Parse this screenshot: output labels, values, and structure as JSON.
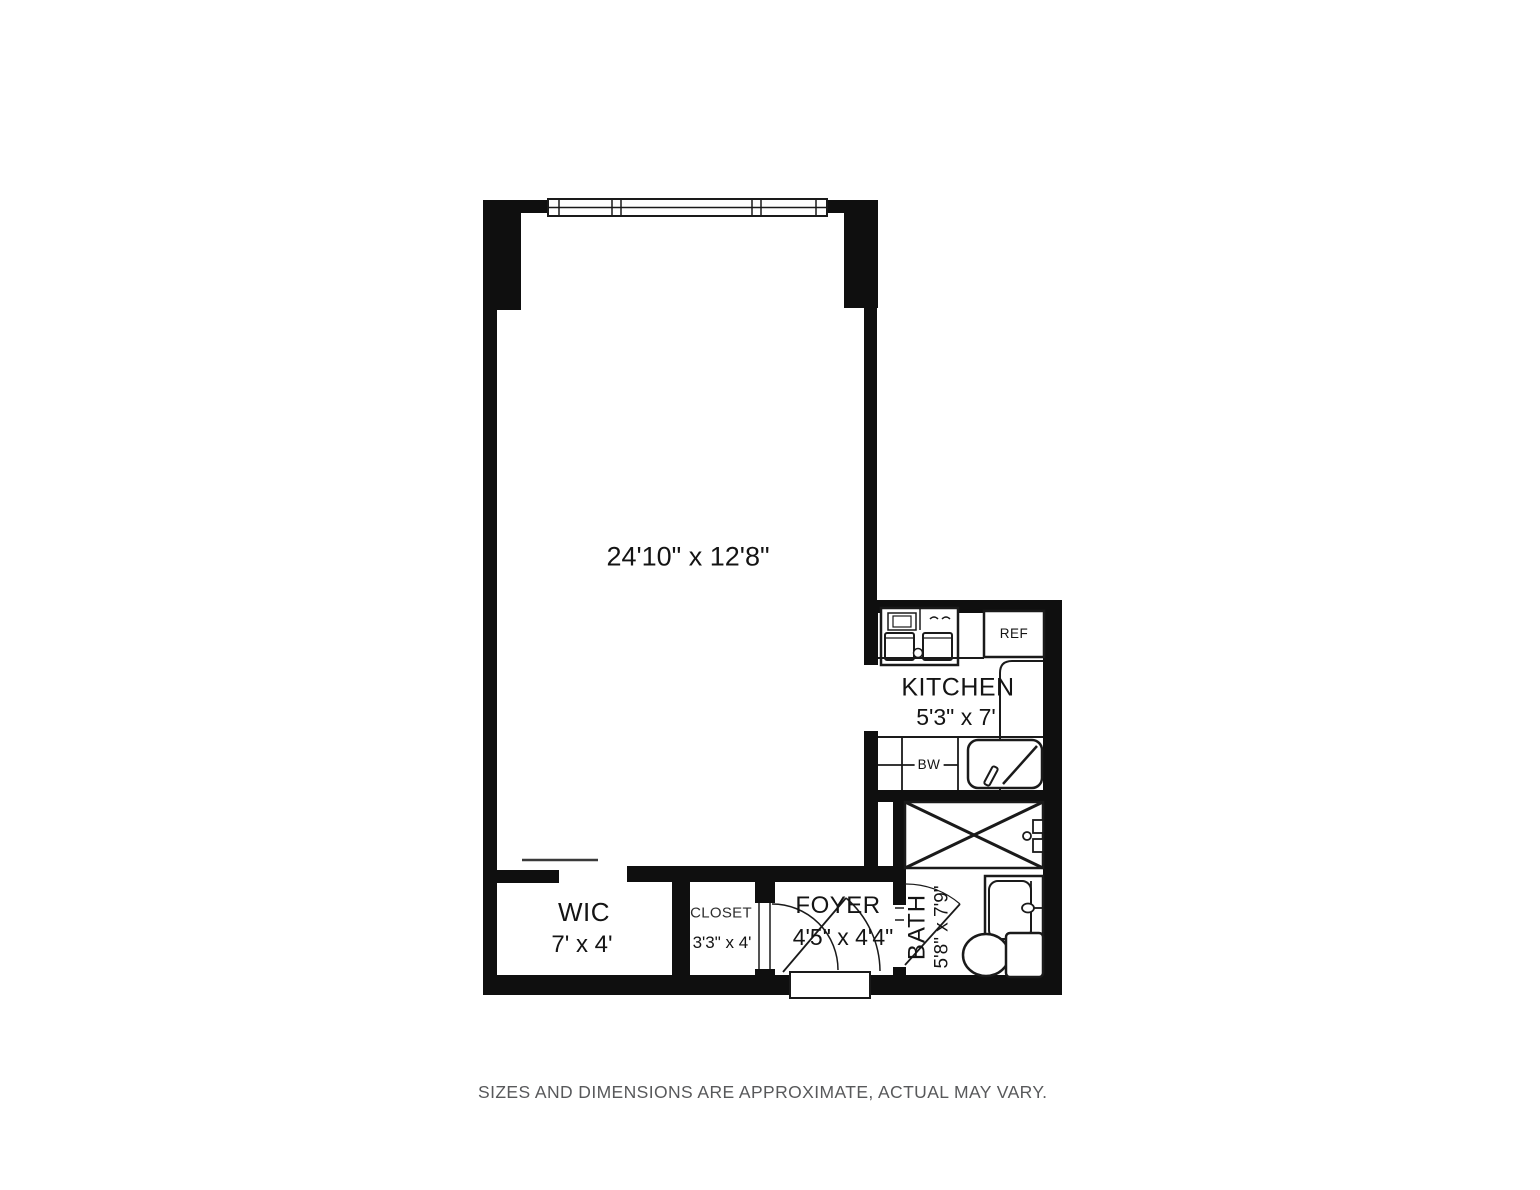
{
  "plan": {
    "main_room": {
      "dimensions": "24'10\" x 12'8\""
    },
    "kitchen": {
      "name": "KITCHEN",
      "dimensions": "5'3\" x 7'",
      "refrigerator_label": "REF",
      "dishwasher_label": "BW"
    },
    "bath": {
      "name": "BATH",
      "dimensions": "5'8\" x 7'9\""
    },
    "wic": {
      "name": "WIC",
      "dimensions": "7' x 4'"
    },
    "closet": {
      "name": "CLOSET",
      "dimensions": "3'3\" x 4'"
    },
    "foyer": {
      "name": "FOYER",
      "dimensions": "4'5\" x 4'4\""
    }
  },
  "footer": {
    "disclaimer": "SIZES AND DIMENSIONS ARE APPROXIMATE, ACTUAL MAY VARY."
  },
  "colors": {
    "wall": "#0f0f0f",
    "line": "#1a1a1a",
    "text": "#141414",
    "muted_text": "#58595b",
    "background": "#ffffff"
  }
}
